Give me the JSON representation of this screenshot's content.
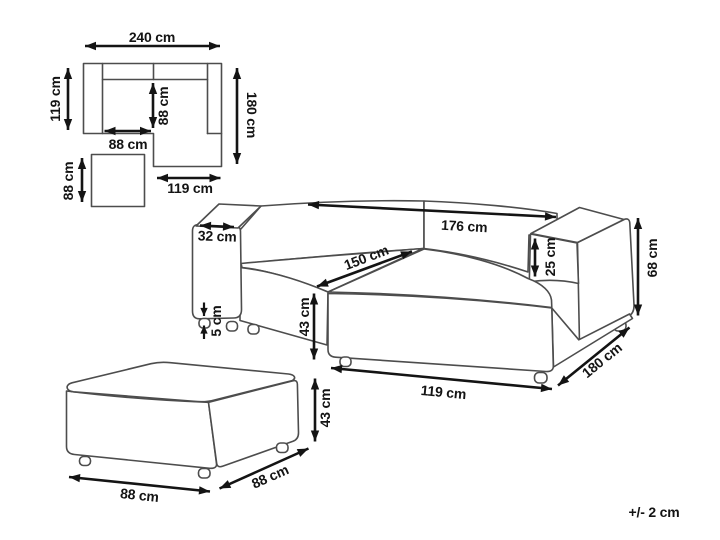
{
  "tolerance_note": "+/- 2 cm",
  "units": "cm",
  "colors": {
    "furniture_line": "#4d4d4d",
    "dimension_line": "#141414",
    "background": "#ffffff"
  },
  "top_view": {
    "total_width": "240 cm",
    "left_depth": "119 cm",
    "right_depth": "180 cm",
    "seat_width": "88 cm",
    "seat_depth": "88 cm",
    "chaise_width": "119 cm",
    "ottoman_size": "88 cm"
  },
  "sofa_3d": {
    "armrest_width": "32 cm",
    "back_width": "176 cm",
    "chaise_length": "150 cm",
    "armrest_above_seat": "25 cm",
    "total_height": "68 cm",
    "seat_height": "43 cm",
    "leg_height": "5 cm",
    "chaise_front_width": "119 cm",
    "side_depth": "180 cm"
  },
  "ottoman_3d": {
    "width": "88 cm",
    "depth": "88 cm",
    "height": "43 cm"
  }
}
